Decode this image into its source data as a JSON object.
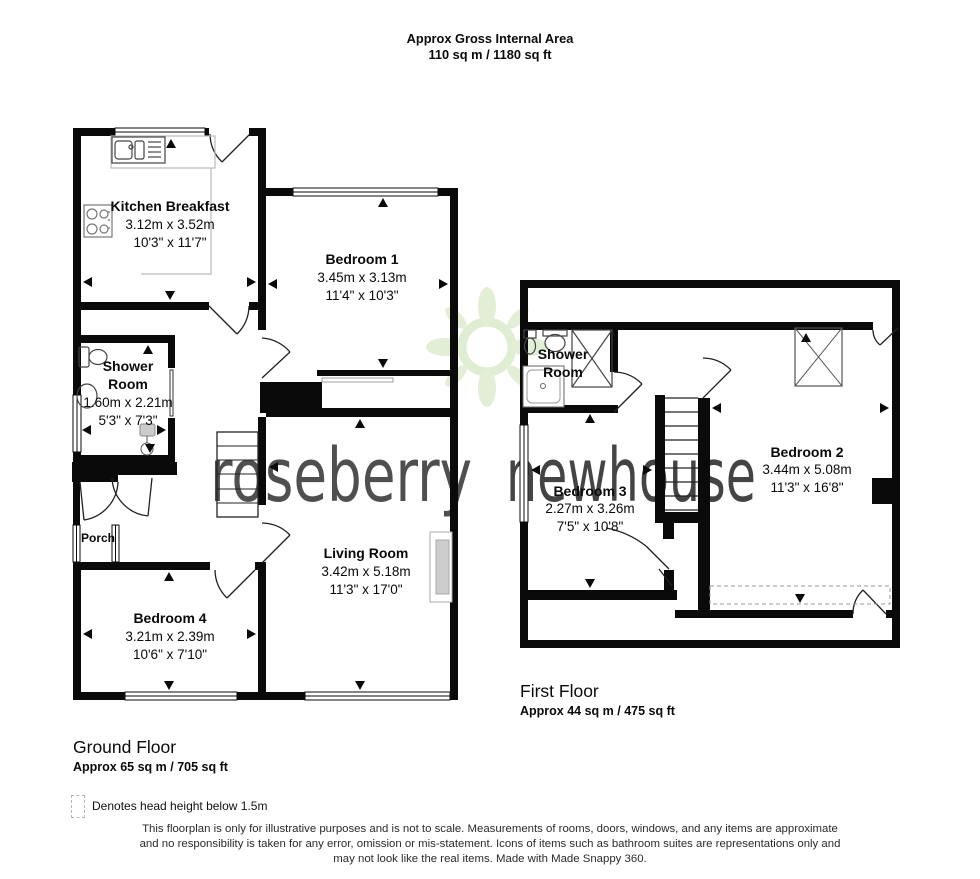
{
  "header": {
    "line1": "Approx Gross Internal Area",
    "line2": "110 sq m / 1180 sq ft"
  },
  "ground_floor": {
    "title": "Ground Floor",
    "area": "Approx 65 sq m / 705 sq ft",
    "rooms": [
      {
        "name": "Kitchen Breakfast",
        "metric": "3.12m x 3.52m",
        "imperial": "10'3\" x 11'7\""
      },
      {
        "name": "Bedroom 1",
        "metric": "3.45m x 3.13m",
        "imperial": "11'4\" x 10'3\""
      },
      {
        "name": "Shower Room",
        "name_lines": [
          "Shower",
          "Room"
        ],
        "metric": "1.60m x 2.21m",
        "imperial": "5'3\" x 7'3\""
      },
      {
        "name": "Living Room",
        "metric": "3.42m x 5.18m",
        "imperial": "11'3\" x 17'0\""
      },
      {
        "name": "Bedroom 4",
        "metric": "3.21m x 2.39m",
        "imperial": "10'6\" x 7'10\""
      },
      {
        "name": "Porch"
      }
    ]
  },
  "first_floor": {
    "title": "First Floor",
    "area": "Approx 44 sq m / 475 sq ft",
    "rooms": [
      {
        "name": "Shower Room",
        "name_lines": [
          "Shower",
          "Room"
        ]
      },
      {
        "name": "Bedroom 3",
        "metric": "2.27m x 3.26m",
        "imperial": "7'5\" x 10'8\""
      },
      {
        "name": "Bedroom 2",
        "metric": "3.44m x 5.08m",
        "imperial": "11'3\" x 16'8\""
      }
    ]
  },
  "legend": {
    "text": "Denotes head height below 1.5m"
  },
  "watermark": {
    "word1": "roseberry",
    "word2": "newhouse",
    "color_gray": "#a9a9a9",
    "color_green": "#c3dcae",
    "emblem_color": "#dcebce"
  },
  "disclaimer": {
    "lines": [
      "This floorplan is only for illustrative purposes and is not to scale. Measurements of rooms, doors, windows, and any items are approximate",
      "and no responsibility is taken for any error, omission or mis-statement. Icons of items such as bathroom suites are representations only and",
      "may not look like the real items. Made with Made Snappy 360."
    ]
  }
}
